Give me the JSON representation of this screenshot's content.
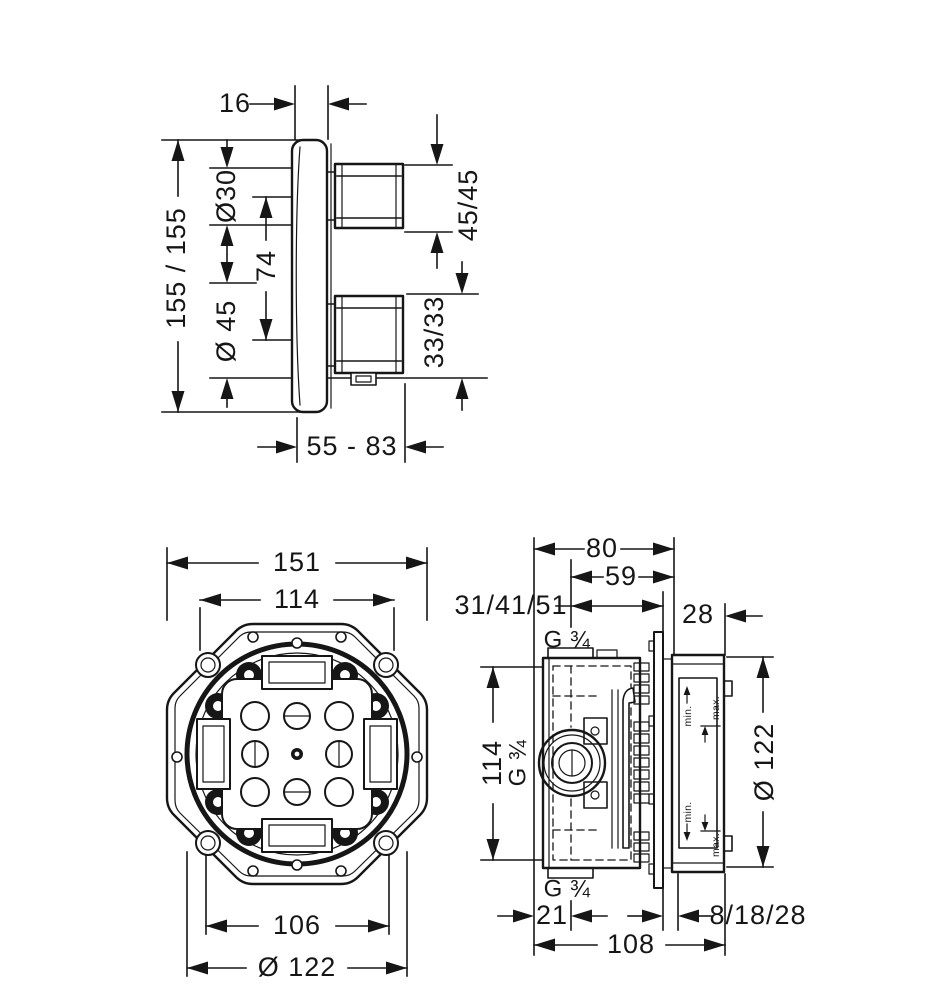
{
  "page": {
    "background_color": "#ffffff",
    "ink_color": "#161616",
    "description": "Installation dimension drawing, concealed thermostatic mixer with rough-in box"
  },
  "trim": {
    "plate_thickness": "16",
    "overall_height": "155 / 155",
    "dia_30": "Ø30",
    "spacing_74": "74",
    "dia_45": "Ø 45",
    "handle_45": "45/45",
    "handle_33": "33/33",
    "depth_range": "55 - 83"
  },
  "front": {
    "width_151": "151",
    "width_114": "114",
    "width_106": "106",
    "dia_122": "Ø 122"
  },
  "side": {
    "depth_80": "80",
    "depth_59": "59",
    "wall_depths": "31/41/51",
    "depth_28": "28",
    "thread_top": "G ¾",
    "height_114": "114",
    "thread_mid": "G ¾",
    "dia_122": "Ø 122",
    "min": "min.",
    "max": "max.",
    "offset_21": "21",
    "thread_bottom": "G ¾",
    "plaster_range": "8/18/28",
    "width_108": "108"
  }
}
